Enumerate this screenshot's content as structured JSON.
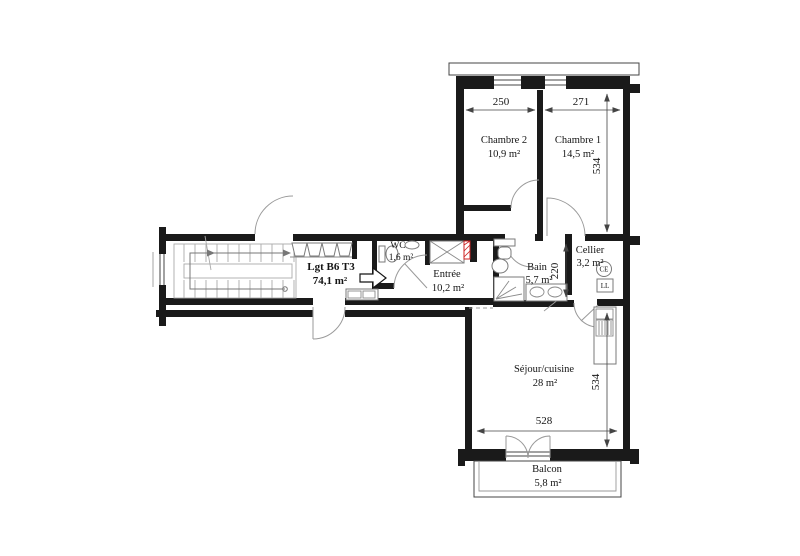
{
  "plan": {
    "title": {
      "label": "Lgt B6 T3",
      "area": "74,1 m²"
    },
    "rooms": {
      "chambre2": {
        "name": "Chambre 2",
        "area": "10,9 m²"
      },
      "chambre1": {
        "name": "Chambre 1",
        "area": "14,5 m²"
      },
      "wc": {
        "name": "WC",
        "area": "1,6 m²"
      },
      "entree": {
        "name": "Entrée",
        "area": "10,2 m²"
      },
      "bain": {
        "name": "Bain",
        "area": "5,7 m²"
      },
      "cellier": {
        "name": "Cellier",
        "area": "3,2 m²"
      },
      "sejour": {
        "name": "Séjour/cuisine",
        "area": "28 m²"
      },
      "balcon": {
        "name": "Balcon",
        "area": "5,8 m²"
      }
    },
    "dimensions": {
      "chambre2_width": "250",
      "chambre1_width": "271",
      "chambre1_height": "534",
      "bain_height": "220",
      "sejour_width": "528",
      "sejour_height": "534"
    },
    "equipment": {
      "water_heater": "CE",
      "washing_machine": "LL"
    }
  }
}
